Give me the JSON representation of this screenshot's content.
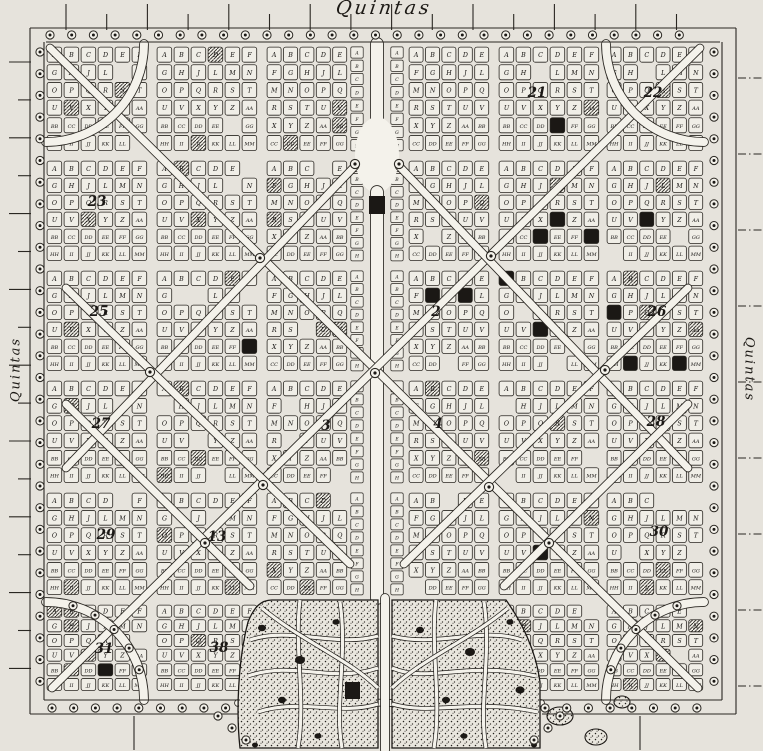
{
  "labels": {
    "top": "Quintas",
    "left": "Quintas",
    "right": "Quintas"
  },
  "plot_letters": [
    "A",
    "B",
    "C",
    "D",
    "E",
    "F",
    "G",
    "H",
    "J",
    "L",
    "M",
    "N",
    "O",
    "P",
    "Q",
    "R",
    "S",
    "T",
    "U",
    "V",
    "X",
    "Y",
    "Z",
    "AA",
    "BB",
    "CC",
    "DD",
    "EE",
    "FF",
    "GG",
    "HH",
    "II",
    "JJ",
    "KK",
    "LL",
    "MM",
    "NN",
    "OO",
    "PP",
    "QQ",
    "RR",
    "SS",
    "TT",
    "UU",
    "VV",
    "XX",
    "YY",
    "ZZ"
  ],
  "section_numbers": [
    {
      "n": "2",
      "x": 436,
      "y": 316
    },
    {
      "n": "3",
      "x": 326,
      "y": 430
    },
    {
      "n": "4",
      "x": 438,
      "y": 428
    },
    {
      "n": "21",
      "x": 537,
      "y": 97
    },
    {
      "n": "22",
      "x": 653,
      "y": 97
    },
    {
      "n": "23",
      "x": 97,
      "y": 206
    },
    {
      "n": "25",
      "x": 99,
      "y": 316
    },
    {
      "n": "26",
      "x": 657,
      "y": 316
    },
    {
      "n": "27",
      "x": 101,
      "y": 428
    },
    {
      "n": "28",
      "x": 656,
      "y": 426
    },
    {
      "n": "29",
      "x": 106,
      "y": 539
    },
    {
      "n": "30",
      "x": 659,
      "y": 536
    },
    {
      "n": "13",
      "x": 217,
      "y": 541
    },
    {
      "n": "31",
      "x": 104,
      "y": 653
    },
    {
      "n": "38",
      "x": 219,
      "y": 652
    }
  ],
  "palette": {
    "paper": "#e6e3dc",
    "road": "#f4f2eb",
    "cell": "#f0eee7",
    "ink": "#1b1815",
    "stroke": "#2a2722",
    "letter": "#141210"
  },
  "decor": {
    "seed": 20250101,
    "hole_rate": 0.025,
    "solid_rate": 0.014,
    "hatch_rate": 0.05
  }
}
